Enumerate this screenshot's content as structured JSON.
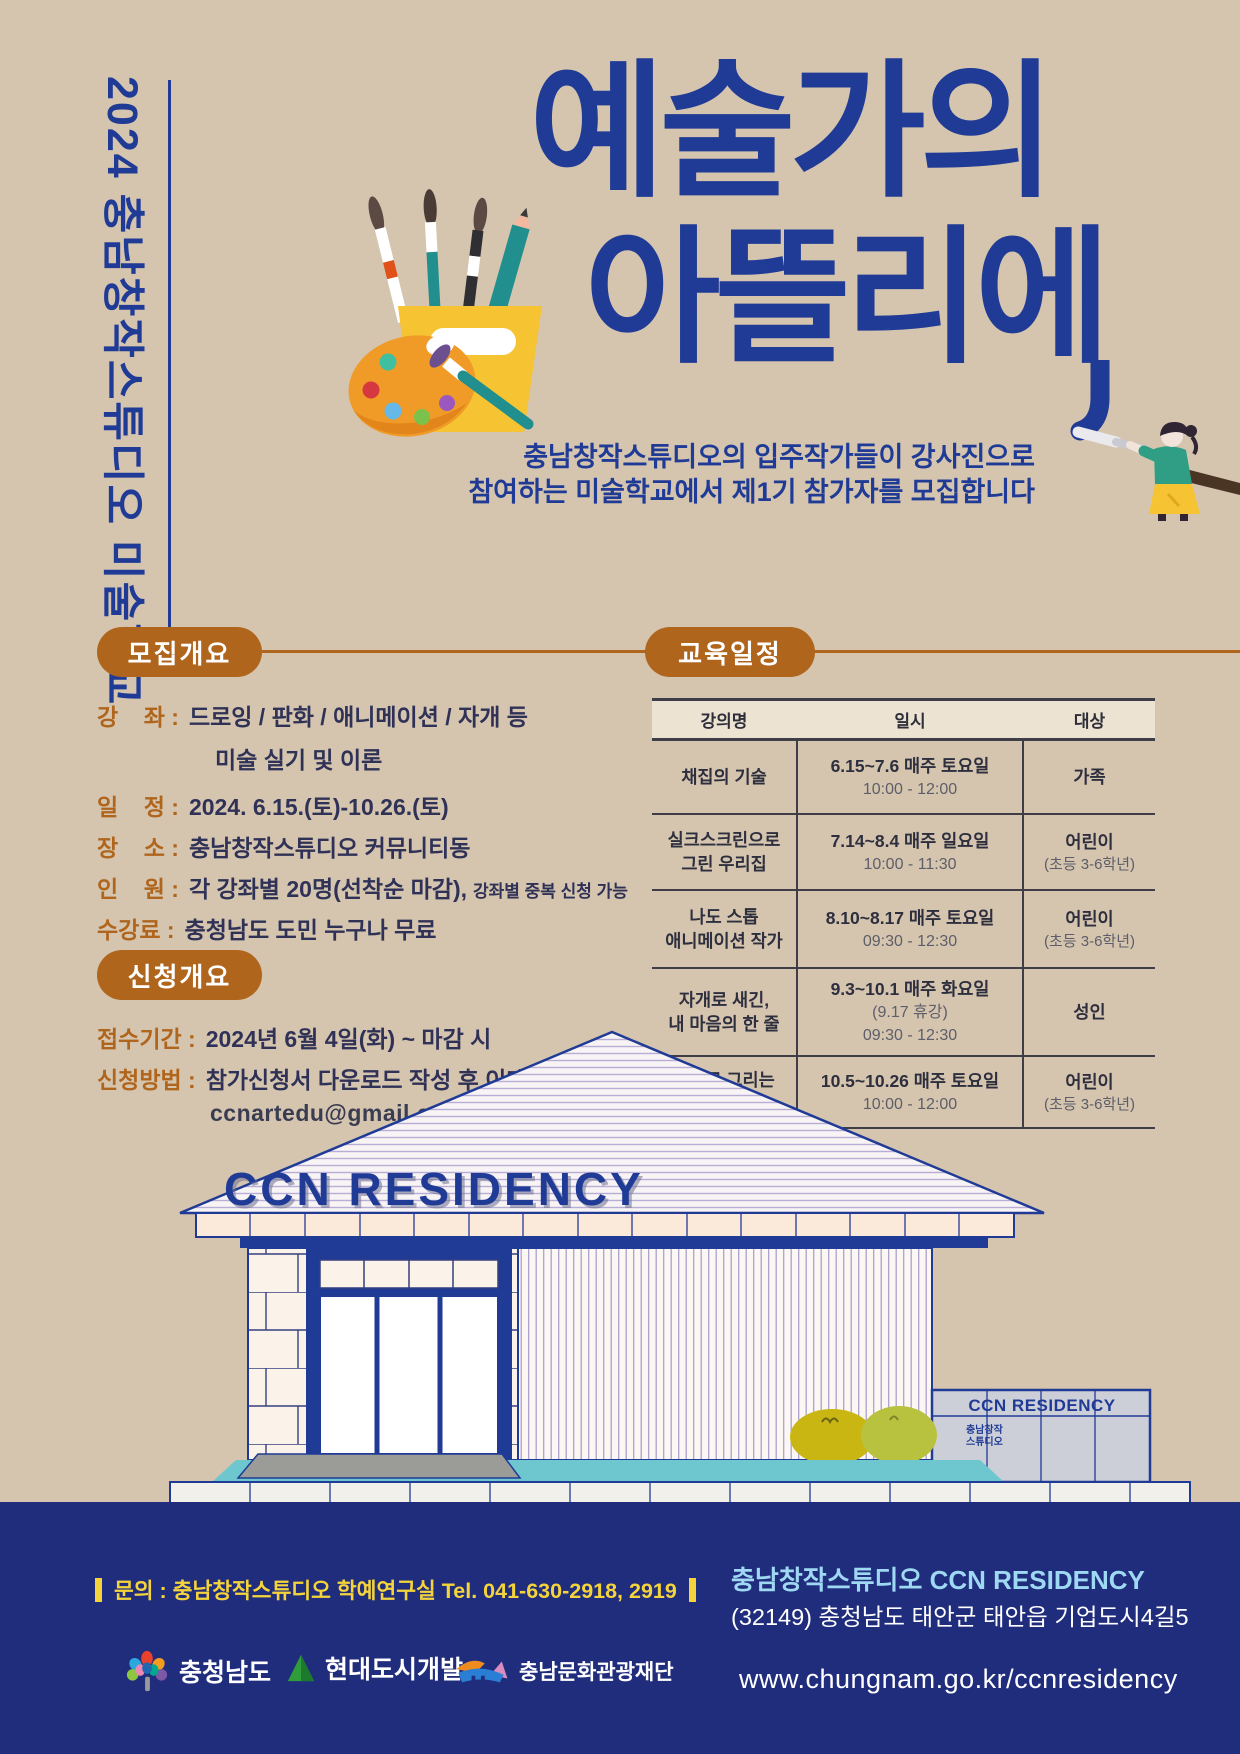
{
  "colors": {
    "background": "#d5c5af",
    "accent_blue": "#203b96",
    "pill_brown": "#b0651d",
    "text_dark": "#2f3256",
    "footer_navy": "#202d7d",
    "footer_yellow": "#f5d43b",
    "footer_lightblue": "#9fd8f3",
    "ground_teal": "#6ec6ce",
    "cup_yellow": "#f6c332",
    "palette_orange": "#f09b27"
  },
  "side_label": "2024 충남창작스튜디오 미술학교",
  "title": {
    "line1": "예술가의",
    "line2": "아뜰리에"
  },
  "subtitle": {
    "line1": "충남창작스튜디오의 입주작가들이 강사진으로",
    "line2": "참여하는 미술학교에서 제1기 참가자를 모집합니다"
  },
  "recruit": {
    "heading": "모집개요",
    "course_label": "강    좌 :",
    "course_value": "드로잉 / 판화 / 애니메이션 / 자개 등",
    "course_value2": "미술 실기 및 이론",
    "date_label": "일    정 :",
    "date_value": "2024. 6.15.(토)-10.26.(토)",
    "place_label": "장    소 :",
    "place_value": "충남창작스튜디오 커뮤니티동",
    "capacity_label": "인    원 :",
    "capacity_value": "각 강좌별 20명(선착순 마감),",
    "capacity_note": "강좌별 중복 신청 가능",
    "fee_label": "수강료 :",
    "fee_value": "충청남도 도민 누구나 무료"
  },
  "apply": {
    "heading": "신청개요",
    "period_label": "접수기간 :",
    "period_value": "2024년 6월 4일(화) ~ 마감 시",
    "method_label": "신청방법 :",
    "method_value": "참가신청서 다운로드 작성 후 이메일 접수",
    "email": "ccnartedu@gmail.com"
  },
  "schedule": {
    "heading": "교육일정",
    "columns": [
      "강의명",
      "일시",
      "대상"
    ],
    "rows": [
      {
        "name1": "채집의 기술",
        "date1": "6.15~7.6 매주 토요일",
        "date2": "10:00 - 12:00",
        "target1": "가족"
      },
      {
        "name1": "실크스크린으로",
        "name2": "그린 우리집",
        "date1": "7.14~8.4 매주 일요일",
        "date2": "10:00 - 11:30",
        "target1": "어린이",
        "target2": "(초등 3-6학년)"
      },
      {
        "name1": "나도 스톱",
        "name2": "애니메이션 작가",
        "date1": "8.10~8.17 매주 토요일",
        "date2": "09:30 - 12:30",
        "target1": "어린이",
        "target2": "(초등 3-6학년)"
      },
      {
        "name1": "자개로 새긴,",
        "name2": "내 마음의 한 줄",
        "date1": "9.3~10.1 매주 화요일",
        "date2": "(9.17 휴강)",
        "date3": "09:30 - 12:30",
        "target1": "성인"
      },
      {
        "name1": "예술로 그리는",
        "name2": "유럽지도",
        "date1": "10.5~10.26 매주 토요일",
        "date2": "10:00 - 12:00",
        "target1": "어린이",
        "target2": "(초등 3-6학년)"
      }
    ]
  },
  "building": {
    "roof_sign": "CCN RESIDENCY",
    "sign_title": "CCN RESIDENCY",
    "sign_sub1": "충남창작",
    "sign_sub2": "스튜디오"
  },
  "footer": {
    "contact": "문의 : 충남창작스튜디오 학예연구실  Tel. 041-630-2918, 2919",
    "org": "충남창작스튜디오 CCN RESIDENCY",
    "address": "(32149) 충청남도 태안군 태안읍 기업도시4길5",
    "url": "www.chungnam.go.kr/ccnresidency",
    "logos": [
      {
        "label": "충청남도"
      },
      {
        "label": "현대도시개발"
      },
      {
        "label": "충남문화관광재단"
      }
    ]
  }
}
